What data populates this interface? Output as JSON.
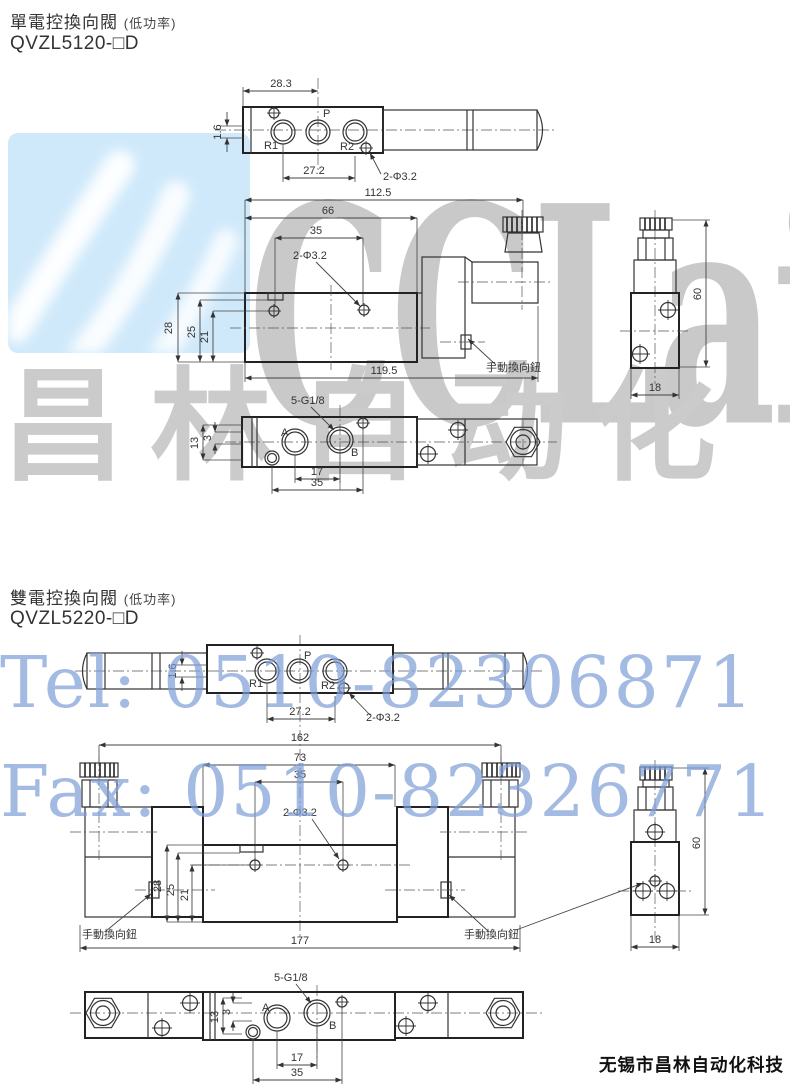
{
  "watermarks": {
    "logo_text": "CCLair",
    "brand_cn": "昌林自动化",
    "tel": "Tel: 0510-82306871",
    "fax": "Fax: 0510-82326771"
  },
  "footer": {
    "company": "无锡市昌林自动化科技"
  },
  "s1": {
    "title": "單電控換向閥",
    "title_note": "(低功率)",
    "model": "QVZL5120-□D",
    "top": {
      "d_28_3": "28.3",
      "d_1_6": "1.6",
      "d_27_2": "27.2",
      "d_holes": "2-Φ3.2",
      "port_r1": "R1",
      "port_p": "P",
      "port_r2": "R2"
    },
    "front": {
      "d_112_5": "112.5",
      "d_66": "66",
      "d_35": "35",
      "d_holes": "2-Φ3.2",
      "d_28": "28",
      "d_25": "25",
      "d_21": "21",
      "d_119_5": "119.5",
      "manual": "手動換向鈕"
    },
    "side": {
      "d_60": "60",
      "d_18": "18"
    },
    "bottom": {
      "d_thread": "5-G1/8",
      "d_13": "13",
      "d_3": "3",
      "d_17": "17",
      "d_35": "35",
      "port_a": "A",
      "port_b": "B"
    }
  },
  "s2": {
    "title": "雙電控換向閥",
    "title_note": "(低功率)",
    "model": "QVZL5220-□D",
    "top": {
      "d_1_6": "1.6",
      "d_27_2": "27.2",
      "d_holes": "2-Φ3.2",
      "port_r1": "R1",
      "port_p": "P",
      "port_r2": "R2"
    },
    "front": {
      "d_162": "162",
      "d_73": "73",
      "d_35": "35",
      "d_holes": "2-Φ3.2",
      "d_28": "28",
      "d_25": "25",
      "d_21": "21",
      "d_177": "177",
      "manual_left": "手動換向鈕",
      "manual_right": "手動換向鈕"
    },
    "side": {
      "d_60": "60",
      "d_18": "18"
    },
    "bottom": {
      "d_thread": "5-G1/8",
      "d_13": "13",
      "d_3": "3",
      "d_17": "17",
      "d_35": "35",
      "port_a": "A",
      "port_b": "B"
    }
  },
  "colors": {
    "blue_block": "#cfe9fb",
    "watermark_gray": "#c9c9c9",
    "watermark_blue": "#7d9ed6",
    "line": "#2e2e2e"
  }
}
